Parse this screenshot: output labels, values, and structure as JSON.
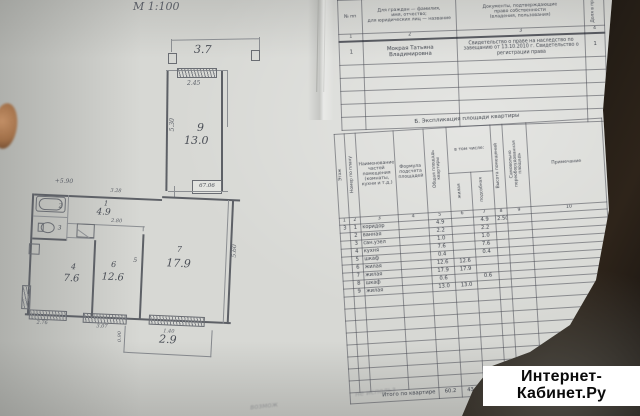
{
  "scale_label": "М 1:100",
  "watermark": {
    "line1": "Интернет-",
    "line2": "Кабинет.Ру"
  },
  "floor_plan": {
    "balcony_top_area": "3.7",
    "room9": {
      "number": "9",
      "area": "13.0",
      "dim_top": "2.45",
      "dim_side": "5.30",
      "stamp": "67.06"
    },
    "elevation_mark": "+5.90",
    "corridor": {
      "number": "1",
      "area": "4.9",
      "dim_top": "3.28",
      "dim_inner": "2.80"
    },
    "bathroom_number": "2",
    "toilet_number": "3",
    "kitchen": {
      "number": "4",
      "area": "7.6"
    },
    "closet_number": "5",
    "room6": {
      "number": "6",
      "area": "12.6"
    },
    "room7": {
      "number": "7",
      "area": "17.9",
      "dim_side": "5.60"
    },
    "balcony_bottom": {
      "area": "2.9",
      "dim_side": "0.90",
      "dim_door": "1.40"
    },
    "bottom_dims": {
      "left": "2.76",
      "mid": "3.07"
    }
  },
  "table_a": {
    "headers": {
      "num": "№ пп",
      "owner_l1": "Для граждан — фамилия,",
      "owner_l2": "имя, отчество;",
      "owner_l3": "для юридических лиц — название",
      "docs_l1": "Документы, подтверждающие",
      "docs_l2": "право собственности",
      "docs_l3": "(владения, пользования)",
      "share": "Доля в праве"
    },
    "col_numbers": [
      "1",
      "2",
      "3",
      "4"
    ],
    "row1": {
      "n": "1",
      "owner": "Мокрая Татьяна Владимировна",
      "docs": "Свидетельство о праве на наследство по завещанию от 13.10.2010 г. Свидетельство о регистрации права",
      "share": "1"
    }
  },
  "table_b": {
    "title": "Б. Экспликация площади квартиры",
    "headers": {
      "floor": "Этаж",
      "num": "Номер по плану",
      "name": "Наименование частей помещения (комнаты, кухни и т.д.)",
      "formula": "Формула подсчета площадей",
      "total": "Общая площадь квартиры",
      "incl": "в том числе:",
      "living": "жилая",
      "aux": "подсобная",
      "height": "Высота помещений",
      "unauth": "Самовольно переоборудованная площадь",
      "note": "Примечание"
    },
    "col_numbers": [
      "1",
      "2",
      "3",
      "4",
      "5",
      "6",
      "7",
      "8",
      "9",
      "10"
    ],
    "rows": [
      {
        "floor": "3",
        "n": "1",
        "name": "коридор",
        "total": "4.9",
        "aux": "4.9",
        "height": "2.50"
      },
      {
        "n": "2",
        "name": "ванная",
        "total": "2.2",
        "aux": "2.2"
      },
      {
        "n": "3",
        "name": "сан.узел",
        "total": "1.0",
        "aux": "1.0"
      },
      {
        "n": "4",
        "name": "кухня",
        "total": "7.6",
        "aux": "7.6"
      },
      {
        "n": "5",
        "name": "шкаф",
        "total": "0.4",
        "aux": "0.4"
      },
      {
        "n": "6",
        "name": "жилая",
        "total": "12.6",
        "living": "12.6"
      },
      {
        "n": "7",
        "name": "жилая",
        "total": "17.9",
        "living": "17.9"
      },
      {
        "n": "8",
        "name": "шкаф",
        "total": "0.6",
        "aux": "0.6"
      },
      {
        "n": "9",
        "name": "жилая",
        "total": "13.0",
        "living": "13.0"
      }
    ],
    "totals": {
      "label": "Итого по квартире",
      "total": "60.2",
      "living": "43.5",
      "aux": "16.7"
    }
  },
  "bleed_text": {
    "line1": "не использ",
    "line2": "возмож"
  }
}
